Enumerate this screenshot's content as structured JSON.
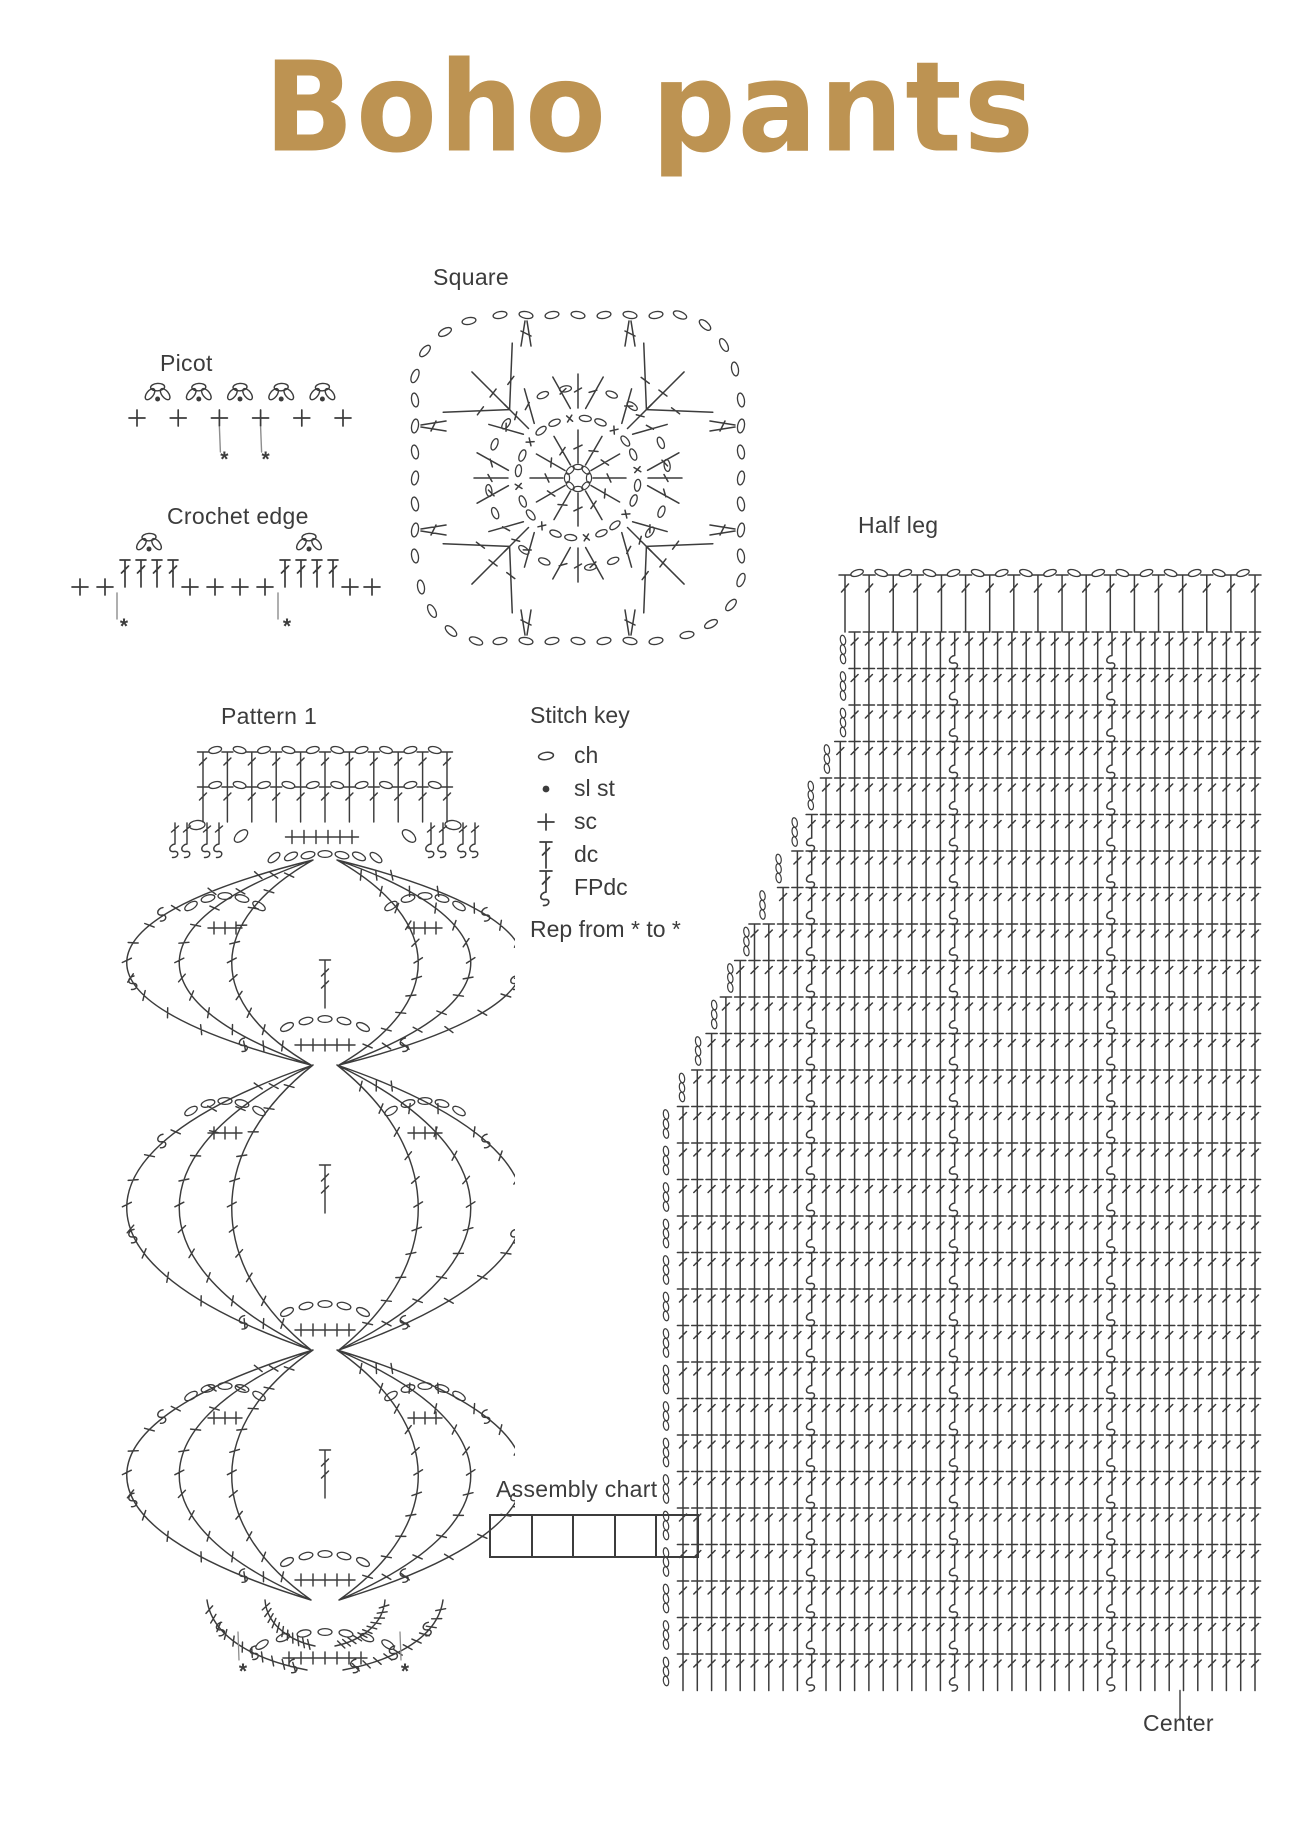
{
  "page": {
    "background": "#ffffff",
    "ink": "#3c3c3c",
    "muted": "#8d8d8d",
    "accent": "#bd9352"
  },
  "title": {
    "text": "Boho pants"
  },
  "labels": {
    "square": "Square",
    "picot": "Picot",
    "crochet_edge": "Crochet edge",
    "half_leg": "Half leg",
    "pattern1": "Pattern 1",
    "assembly": "Assembly chart",
    "center": "Center"
  },
  "stitch_key": {
    "title": "Stitch key",
    "items": [
      {
        "symbol": "ch",
        "label": "ch"
      },
      {
        "symbol": "sl-st",
        "label": "sl st"
      },
      {
        "symbol": "sc",
        "label": "sc"
      },
      {
        "symbol": "dc",
        "label": "dc"
      },
      {
        "symbol": "fpdc",
        "label": "FPdc"
      }
    ],
    "note": "Rep from * to *"
  },
  "marker": "*",
  "diagrams": {
    "picot": {
      "sc_count": 6,
      "picot_count": 5,
      "marked_sc": [
        3,
        4
      ]
    },
    "crochet_edge": {
      "lead_sc": 2,
      "dc_group_size": 4,
      "mid_sc": 4,
      "tail_sc": 2,
      "picot_groups": 2,
      "marked_points": 2
    },
    "square": {
      "spokes": 12,
      "ring_slots": 24,
      "shells": 8,
      "border_sides": 4
    },
    "pattern1": {
      "band_rows": 2,
      "band_posts": 11,
      "tiers": 3,
      "center_plus": 6,
      "bottom_plus": 7
    },
    "half_leg": {
      "rows": 29,
      "row_height": 36.5,
      "col_width": 14.3,
      "top_posts": 18,
      "fpdc_columns": [
        10,
        21,
        31
      ],
      "straight_rows_top": 3,
      "diagonal_end_row": 13
    },
    "assembly": {
      "cells": 5
    }
  }
}
